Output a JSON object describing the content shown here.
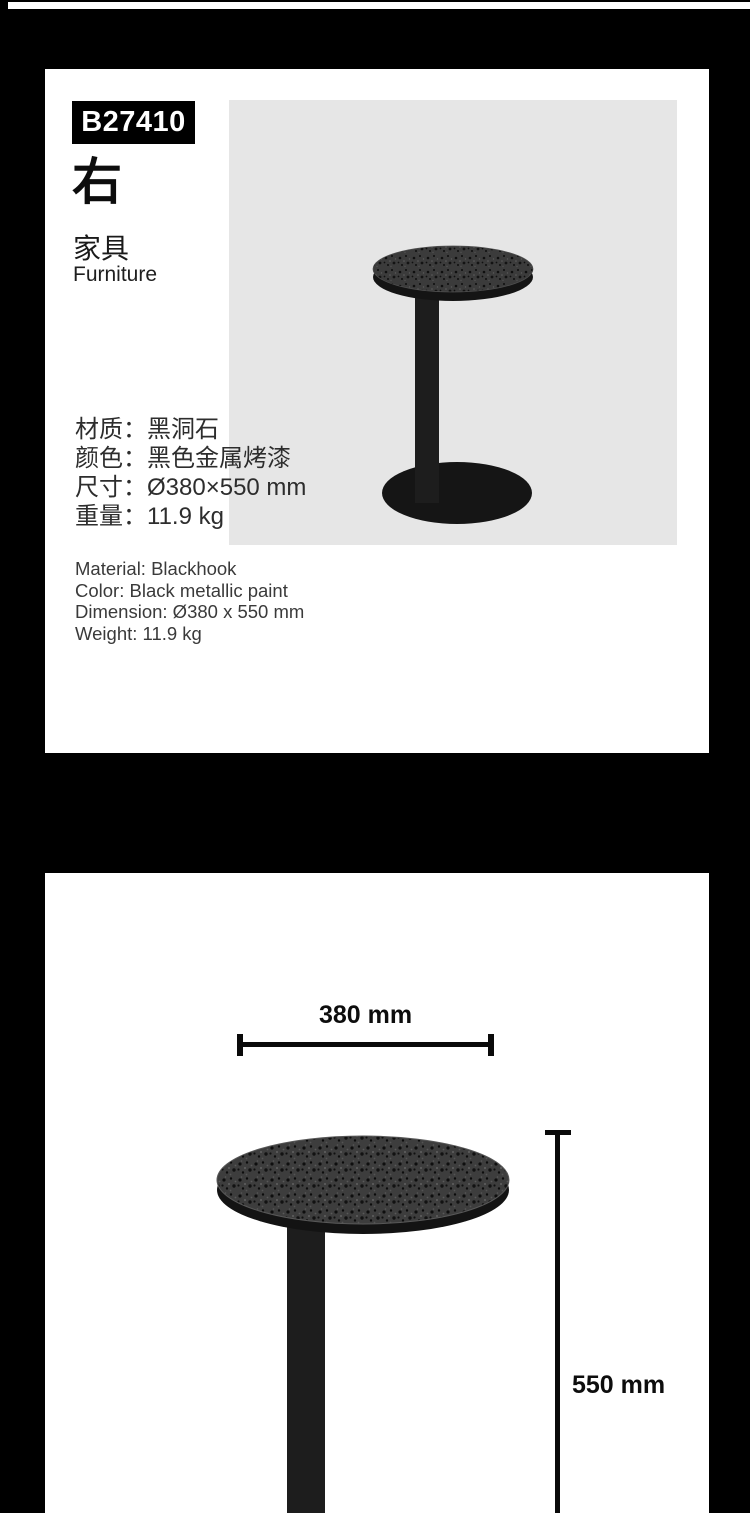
{
  "product_card": {
    "sku": "B27410",
    "variant": "右",
    "category_zh": "家具",
    "category_en": "Furniture",
    "specs_zh": [
      "材质：黑洞石",
      "颜色：黑色金属烤漆",
      "尺寸：Ø380×550 mm",
      "重量：11.9 kg"
    ],
    "specs_en": [
      "Material: Blackhook",
      "Color: Black metallic paint",
      "Dimension: Ø380 x 550 mm",
      "Weight: 11.9 kg"
    ]
  },
  "dimension_card": {
    "width_label": "380 mm",
    "height_label": "550 mm"
  },
  "colors": {
    "page_bg": "#000000",
    "card_bg": "#ffffff",
    "photo_bg": "#e6e6e6",
    "badge_bg": "#000000",
    "badge_text": "#ffffff",
    "dimension_line": "#0a0a0a",
    "table_black": "#1a1a1a"
  }
}
